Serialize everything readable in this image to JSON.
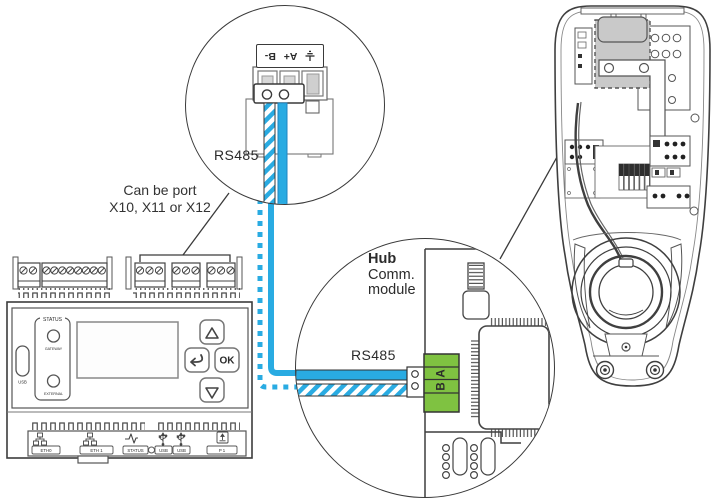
{
  "colors": {
    "wire_blue": "#29ABE2",
    "terminal_green": "#7FC241",
    "module_gray": "#C9C9C9",
    "outline": "#3E3E3E"
  },
  "callout": {
    "line1": "Can be port",
    "line2": "X10, X11 or X12"
  },
  "top_detail": {
    "port_label": "RS485",
    "terminal": {
      "ground_icon": "ground-icon",
      "pin_aplus": "A+",
      "pin_bminus": "B-"
    }
  },
  "hub_detail": {
    "title_line1": "Hub",
    "title_line2": "Comm.",
    "title_line3": "module",
    "port_label": "RS485",
    "terminal_pins": {
      "a": "A",
      "b": "B"
    }
  },
  "controller": {
    "status_group_label": "STATUS",
    "gateway_led_label": "GATEWAY",
    "external_led_label": "EXTERNAL",
    "usb_port_label": "USB",
    "ok_button_label": "OK",
    "bottom_ports": [
      {
        "label": "ETH0",
        "icon": "ethernet-icon"
      },
      {
        "label": "ETH 1",
        "icon": "ethernet-icon"
      },
      {
        "label": "STATUS",
        "icon": "waveform-icon"
      },
      {
        "label": "USB",
        "icon": "usb-icon"
      },
      {
        "label": "USB",
        "icon": "usb-icon"
      },
      {
        "label": "P 1",
        "icon": "p1-box-arrow-icon"
      }
    ]
  }
}
